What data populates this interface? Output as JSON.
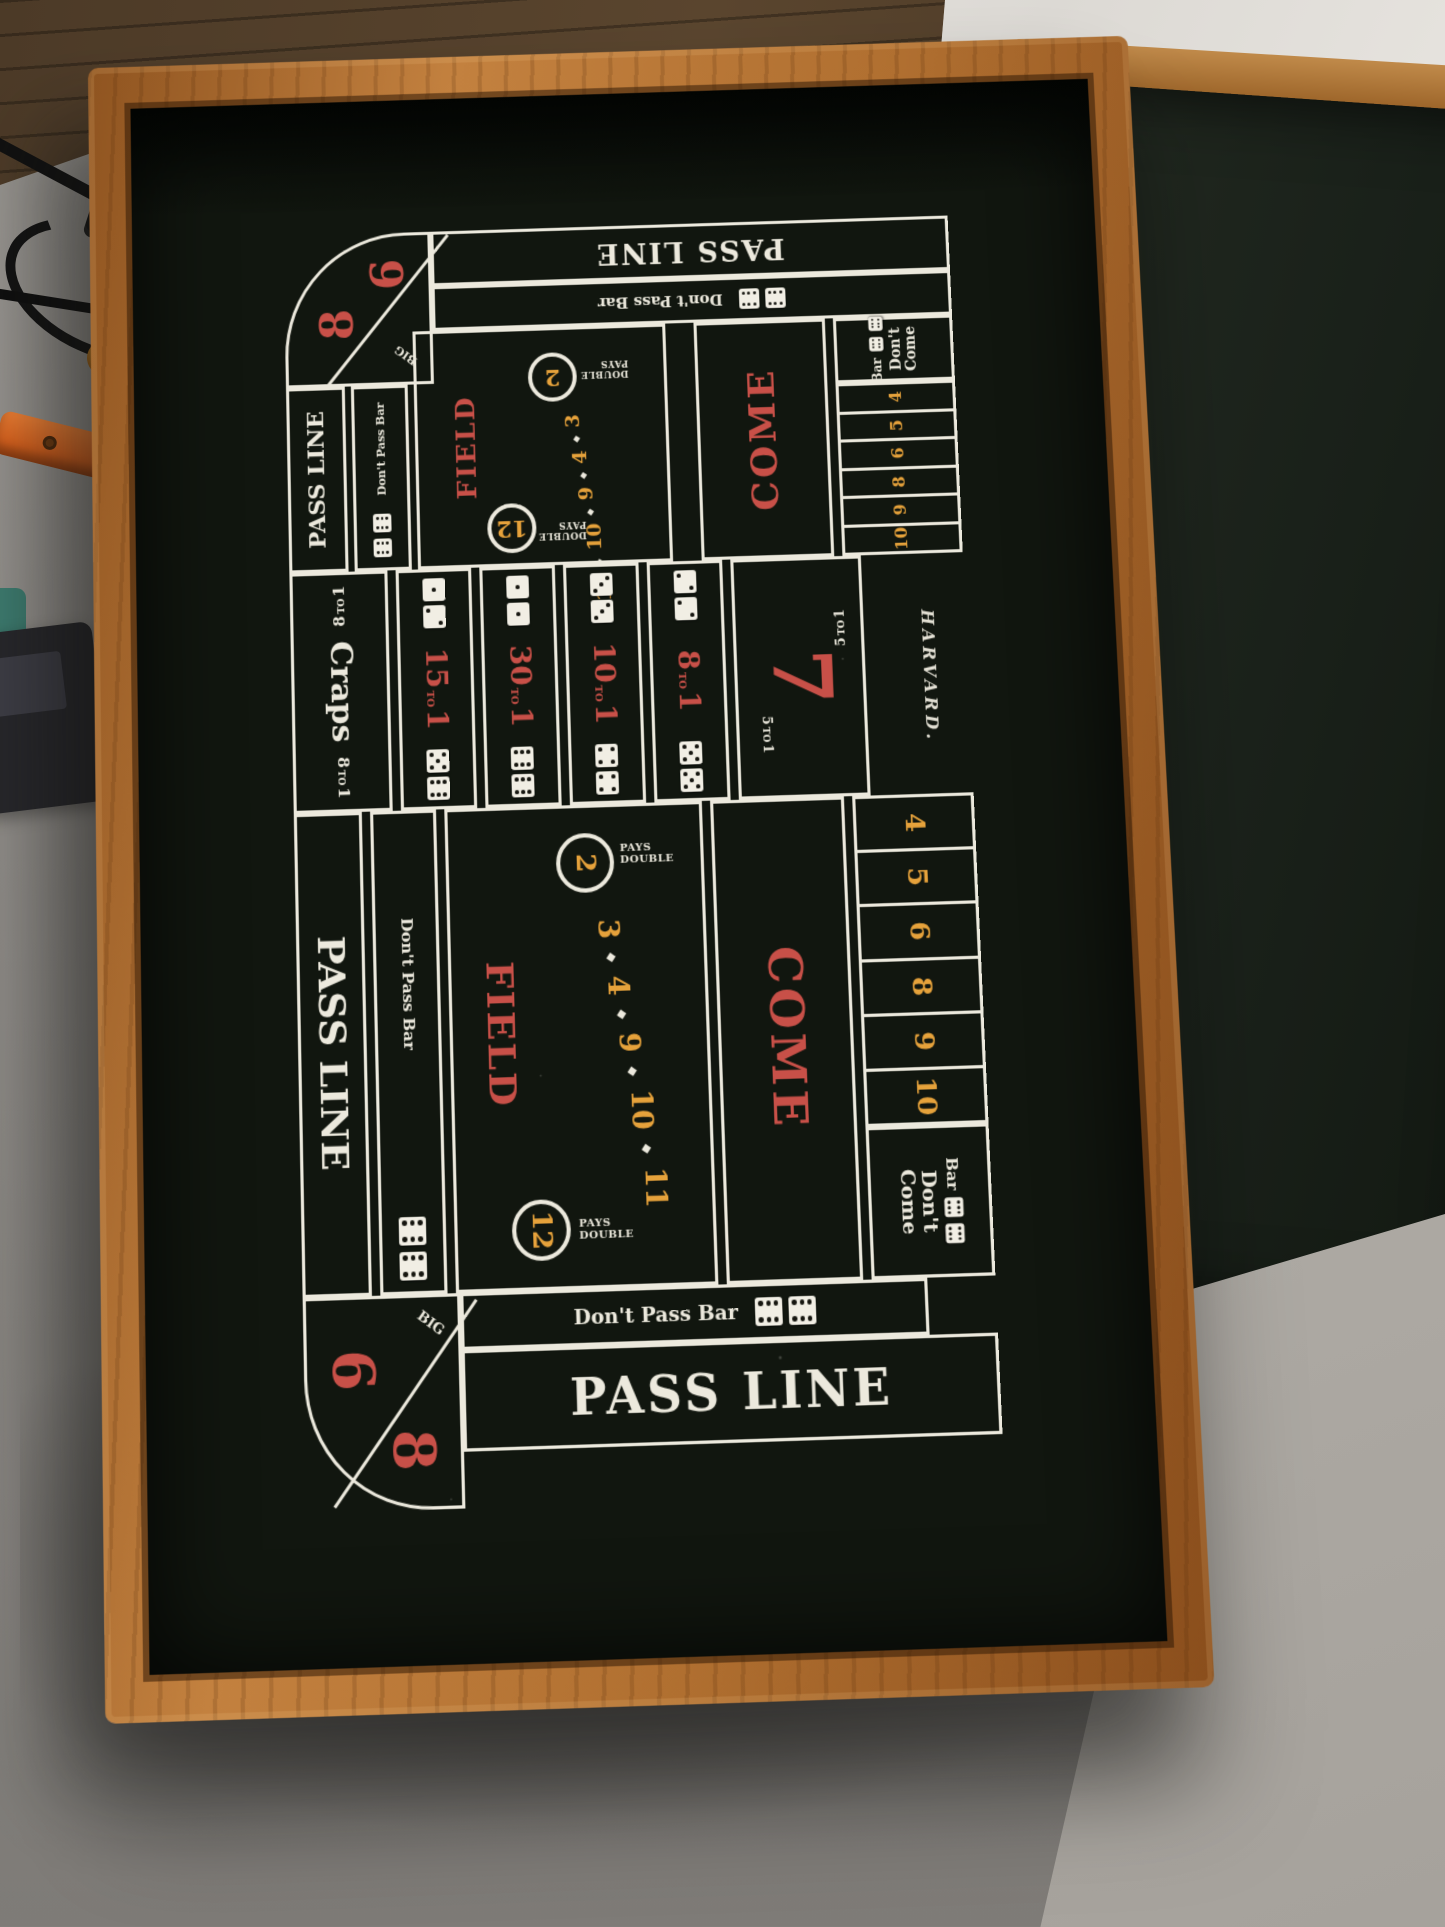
{
  "board": {
    "brand": "HARVARD.",
    "half": {
      "pass_line": "PASS LINE",
      "dont_pass_bar": "Don't Pass Bar",
      "bar": "Bar",
      "dont_come_l1": "Don't",
      "dont_come_l2": "Come",
      "come": "COME",
      "big_label": "BIG",
      "big_numbers": [
        "6",
        "8"
      ],
      "point_numbers": [
        "4",
        "5",
        "6",
        "8",
        "9",
        "10"
      ],
      "field": {
        "name": "FIELD",
        "pays": "PAYS",
        "double": "DOUBLE",
        "two": "2",
        "run": [
          "3",
          "4",
          "9",
          "10",
          "11"
        ],
        "twelve": "12"
      },
      "dont_pass_dice": [
        6,
        6
      ],
      "dont_pass_col_dice": [
        6,
        6
      ],
      "bar_dice": [
        6,
        6
      ]
    },
    "center": {
      "craps": {
        "label": "Craps",
        "odds_num": "8"
      },
      "seven": {
        "label": "7",
        "odds_num": "5"
      },
      "to_label": "TO",
      "one_label": "1",
      "prop_bets": [
        {
          "odds_num": "15",
          "top_dice": [
            1,
            2
          ],
          "bottom_dice": [
            5,
            6
          ]
        },
        {
          "odds_num": "30",
          "top_dice": [
            1,
            1
          ],
          "bottom_dice": [
            6,
            6
          ]
        },
        {
          "odds_num": "10",
          "top_dice": [
            3,
            3
          ],
          "bottom_dice": [
            4,
            4
          ]
        },
        {
          "odds_num": "8",
          "top_dice": [
            2,
            2
          ],
          "bottom_dice": [
            5,
            5
          ]
        }
      ]
    },
    "colors": {
      "felt": "#11160f",
      "line": "#ece9dd",
      "red": "#c85048",
      "amber": "#e6a23b",
      "wood": "#b4753a"
    }
  }
}
